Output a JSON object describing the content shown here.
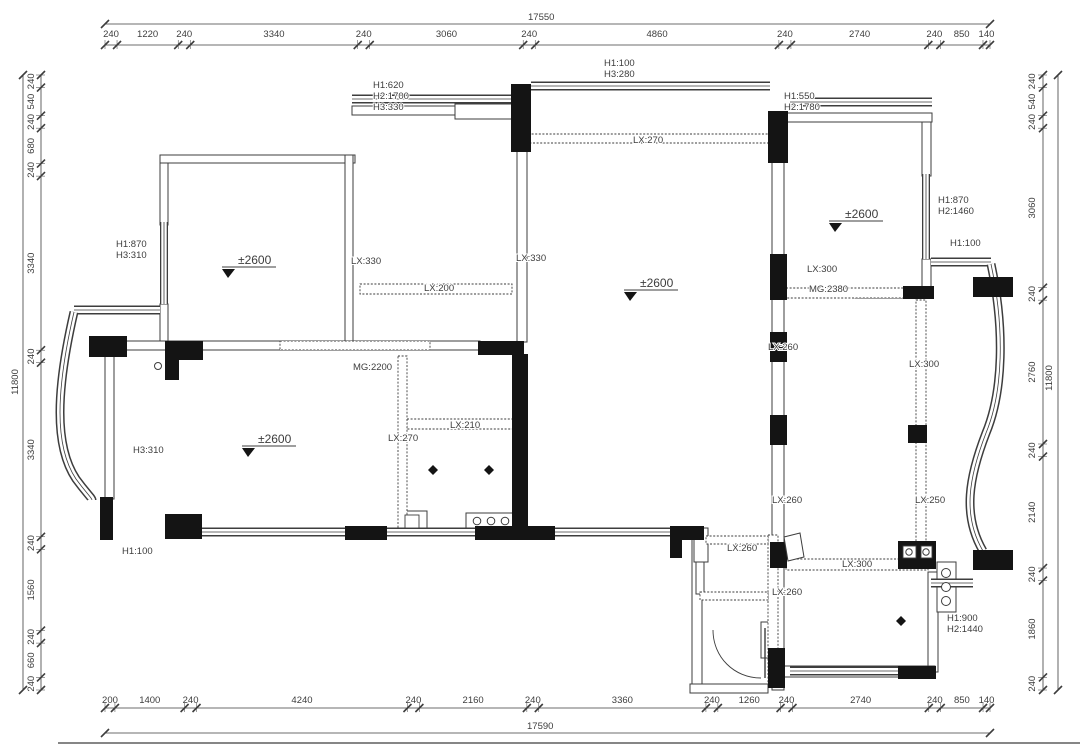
{
  "drawing": {
    "line_color": "#3d3d3d",
    "fill_color": "#141414",
    "background": "#ffffff",
    "level_mark_text": "±2600"
  },
  "dim_chains": {
    "top": {
      "total": "17550",
      "segments": [
        "240",
        "1220",
        "240",
        "3340",
        "240",
        "3060",
        "240",
        "4860",
        "240",
        "2740",
        "240",
        "850",
        "140"
      ]
    },
    "bottom": {
      "total": "17590",
      "segments": [
        "200",
        "1400",
        "240",
        "4240",
        "240",
        "2160",
        "240",
        "3360",
        "240",
        "1260",
        "240",
        "2740",
        "240",
        "850",
        "140"
      ]
    },
    "left": {
      "total": "11800",
      "segments": [
        "240",
        "540",
        "240",
        "680",
        "240",
        "3340",
        "240",
        "3340",
        "240",
        "1560",
        "240",
        "660",
        "240"
      ]
    },
    "right": {
      "total": "11800",
      "segments": [
        "240",
        "540",
        "240",
        "3060",
        "240",
        "2760",
        "240",
        "2140",
        "240",
        "1860",
        "240"
      ]
    }
  },
  "annotations": [
    {
      "text": "H1:620",
      "x": 373,
      "y": 88
    },
    {
      "text": "H2:1700",
      "x": 373,
      "y": 99
    },
    {
      "text": "H3:330",
      "x": 373,
      "y": 110
    },
    {
      "text": "H1:100",
      "x": 604,
      "y": 66
    },
    {
      "text": "H3:280",
      "x": 604,
      "y": 77
    },
    {
      "text": "H1:550",
      "x": 784,
      "y": 99
    },
    {
      "text": "H2:1780",
      "x": 784,
      "y": 110
    },
    {
      "text": "LX:270",
      "x": 633,
      "y": 143
    },
    {
      "text": "H1:870",
      "x": 938,
      "y": 203
    },
    {
      "text": "H2:1460",
      "x": 938,
      "y": 214
    },
    {
      "text": "H1:100",
      "x": 950,
      "y": 246
    },
    {
      "text": "H1:870",
      "x": 116,
      "y": 247
    },
    {
      "text": "H3:310",
      "x": 116,
      "y": 258
    },
    {
      "text": "LX:330",
      "x": 351,
      "y": 264
    },
    {
      "text": "LX:330",
      "x": 516,
      "y": 261
    },
    {
      "text": "LX:200",
      "x": 424,
      "y": 291
    },
    {
      "text": "LX:300",
      "x": 807,
      "y": 272
    },
    {
      "text": "MG:2380",
      "x": 809,
      "y": 292
    },
    {
      "text": "LX:260",
      "x": 768,
      "y": 350
    },
    {
      "text": "MG:2200",
      "x": 353,
      "y": 370
    },
    {
      "text": "LX:300",
      "x": 909,
      "y": 367
    },
    {
      "text": "LX:210",
      "x": 450,
      "y": 428
    },
    {
      "text": "LX:270",
      "x": 388,
      "y": 441
    },
    {
      "text": "H3:310",
      "x": 133,
      "y": 453
    },
    {
      "text": "LX:260",
      "x": 772,
      "y": 503
    },
    {
      "text": "LX:250",
      "x": 915,
      "y": 503
    },
    {
      "text": "H1:100",
      "x": 122,
      "y": 554
    },
    {
      "text": "LX:260",
      "x": 727,
      "y": 551
    },
    {
      "text": "LX:300",
      "x": 842,
      "y": 567
    },
    {
      "text": "LX:260",
      "x": 772,
      "y": 595
    },
    {
      "text": "H1:900",
      "x": 947,
      "y": 621
    },
    {
      "text": "H2:1440",
      "x": 947,
      "y": 632
    }
  ],
  "level_markers": [
    {
      "x": 238,
      "y": 264
    },
    {
      "x": 640,
      "y": 287
    },
    {
      "x": 845,
      "y": 218
    },
    {
      "x": 258,
      "y": 443
    }
  ]
}
